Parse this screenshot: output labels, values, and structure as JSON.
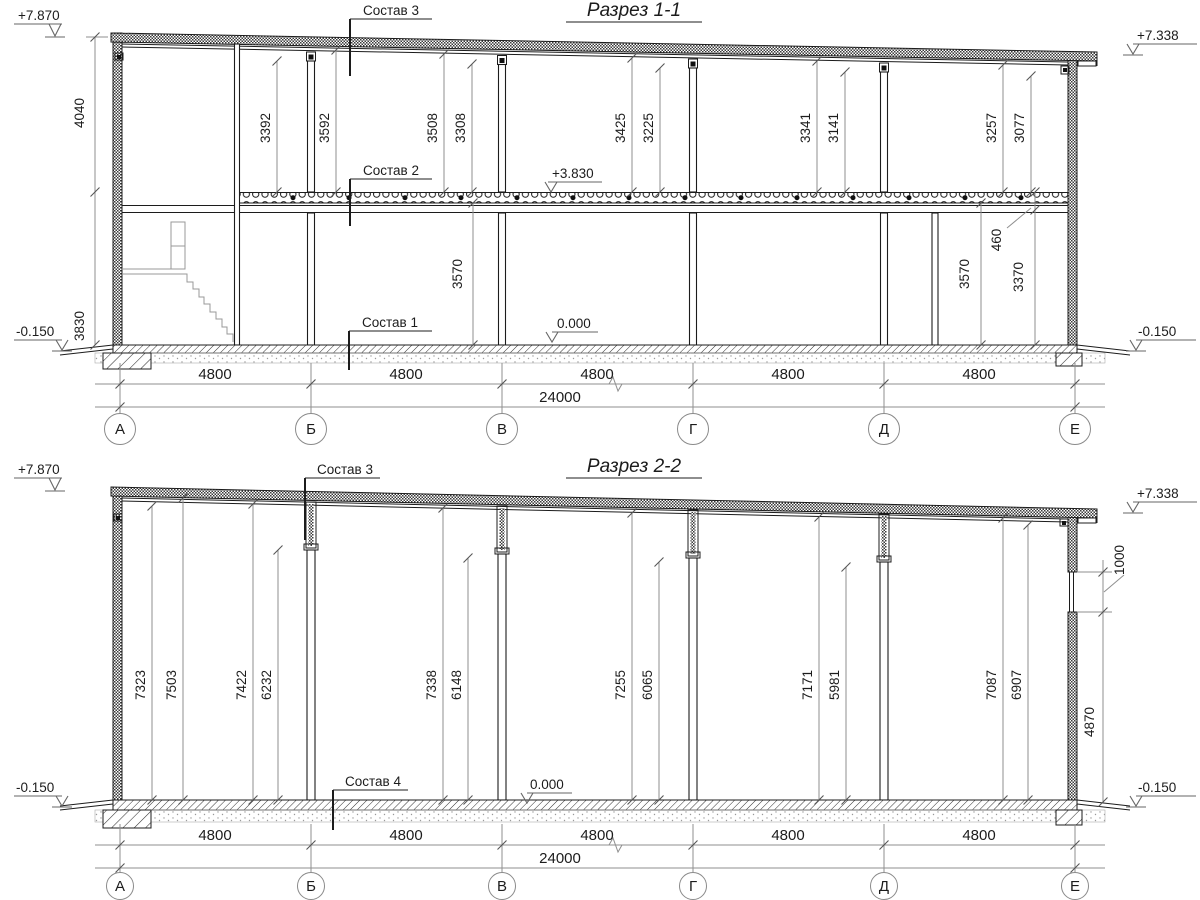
{
  "colors": {
    "ink": "#1c1c1c",
    "aux_line": "#8f8f8f",
    "paper": "#ffffff"
  },
  "section1": {
    "title": "Разрез 1-1",
    "leaders": {
      "sostav3": "Состав 3",
      "sostav2": "Состав 2",
      "sostav1": "Состав 1"
    },
    "elevations": {
      "top_left": "+7.870",
      "roof_right": "+7.338",
      "floor2": "+3.830",
      "zero": "0.000",
      "ground_left": "-0.150",
      "ground_right": "-0.150"
    },
    "left_dims": {
      "upper": "4040",
      "lower": "3830"
    },
    "floor2_dims": [
      "3392",
      "3592",
      "3508",
      "3308",
      "3425",
      "3225",
      "3341",
      "3141",
      "3257",
      "3077"
    ],
    "floor1_dims": {
      "left": "3570",
      "right_a": "3570",
      "right_b": "3370",
      "beam": "460"
    },
    "bay_dims": [
      "4800",
      "4800",
      "4800",
      "4800",
      "4800"
    ],
    "total_dim": "24000",
    "axes": [
      "А",
      "Б",
      "В",
      "Г",
      "Д",
      "Е"
    ]
  },
  "section2": {
    "title": "Разрез 2-2",
    "leaders": {
      "sostav3": "Состав 3",
      "sostav4": "Состав 4"
    },
    "elevations": {
      "top_left": "+7.870",
      "roof_right": "+7.338",
      "zero": "0.000",
      "ground_left": "-0.150",
      "ground_right": "-0.150"
    },
    "col_dims": [
      "7323",
      "7503",
      "7422",
      "6232",
      "7338",
      "6148",
      "7255",
      "6065",
      "7171",
      "5981",
      "7087",
      "6907"
    ],
    "right_dims": {
      "window": "1000",
      "wall_lower": "4870"
    },
    "bay_dims": [
      "4800",
      "4800",
      "4800",
      "4800",
      "4800"
    ],
    "total_dim": "24000",
    "axes": [
      "А",
      "Б",
      "В",
      "Г",
      "Д",
      "Е"
    ]
  }
}
